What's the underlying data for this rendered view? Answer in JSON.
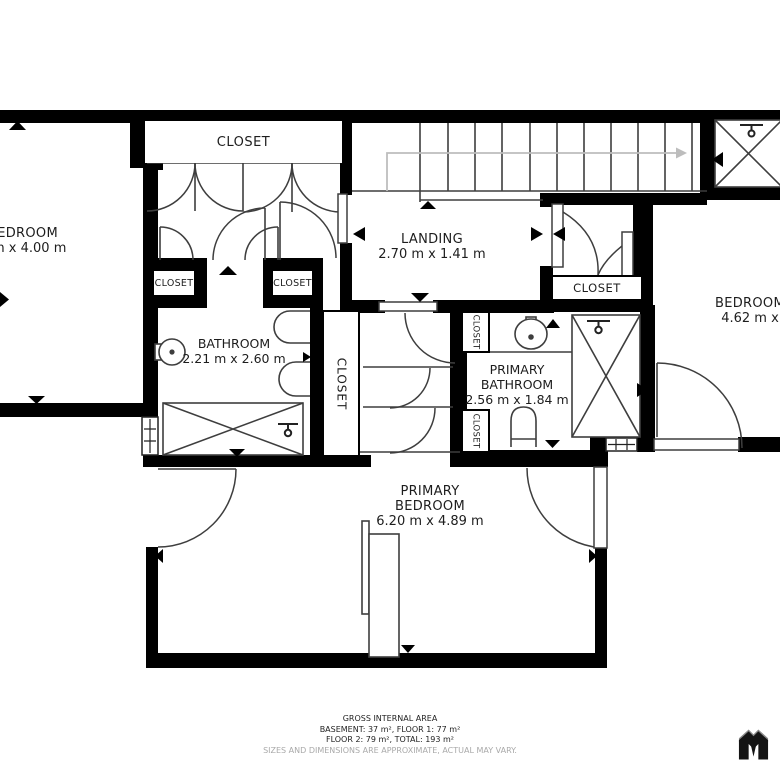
{
  "colors": {
    "wall": "#000000",
    "line": "#3e3e3e",
    "walkline": "#bdbdbd",
    "text": "#1d1d1d",
    "muted": "#a9a9a9"
  },
  "rooms": {
    "closet_top": {
      "label": "CLOSET"
    },
    "bedroom_left": {
      "label": "BEDROOM",
      "dims": "7 m x 4.00 m"
    },
    "landing": {
      "label": "LANDING",
      "dims": "2.70 m x 1.41 m"
    },
    "closet_hall_left": {
      "label": "CLOSET"
    },
    "closet_hall_right": {
      "label": "CLOSET"
    },
    "bathroom": {
      "label": "BATHROOM",
      "dims": "2.21 m x 2.60 m"
    },
    "closet_column": {
      "label": "CLOSET"
    },
    "closet_stairs": {
      "label": "CLOSET"
    },
    "primary_bathroom": {
      "label_line1": "PRIMARY",
      "label_line2": "BATHROOM",
      "dims": "2.56 m x 1.84 m"
    },
    "closet_pb_top": {
      "label": "CLOSET"
    },
    "closet_pb_bottom": {
      "label": "CLOSET"
    },
    "bedroom_right": {
      "label": "BEDROOM",
      "dims": "4.62 m x"
    },
    "primary_bedroom": {
      "label_line1": "PRIMARY",
      "label_line2": "BEDROOM",
      "dims": "6.20 m x 4.89 m"
    }
  },
  "footer": {
    "title": "GROSS INTERNAL AREA",
    "line1": "BASEMENT: 37 m², FLOOR 1: 77 m²",
    "line2": "FLOOR 2: 79 m², TOTAL: 193 m²",
    "disclaimer": "SIZES AND DIMENSIONS ARE APPROXIMATE, ACTUAL MAY VARY."
  }
}
